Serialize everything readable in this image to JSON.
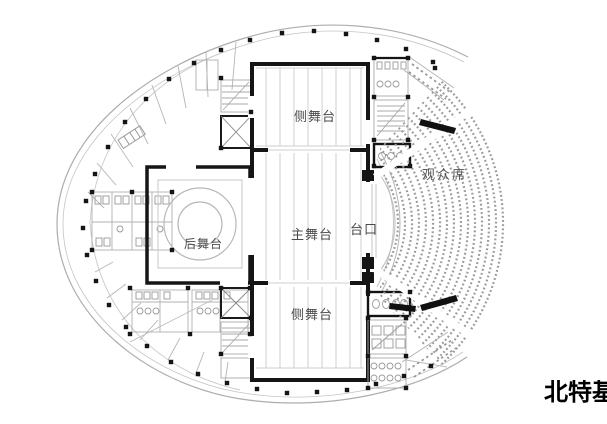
{
  "title": "theater-floor-plan",
  "labels": {
    "side_stage_top": "侧舞台",
    "main_stage": "主舞台",
    "side_stage_bottom": "侧舞台",
    "rear_stage": "后舞台",
    "proscenium": "台口",
    "audience": "观众席"
  },
  "watermark": {
    "text": "北特",
    "partial_char": "基"
  },
  "colors": {
    "wall": "#151515",
    "line_light": "#b0b0b0",
    "line_faint": "#cfcfcf",
    "label": "#4a4a4a",
    "watermark": "#000000",
    "background": "#ffffff"
  }
}
